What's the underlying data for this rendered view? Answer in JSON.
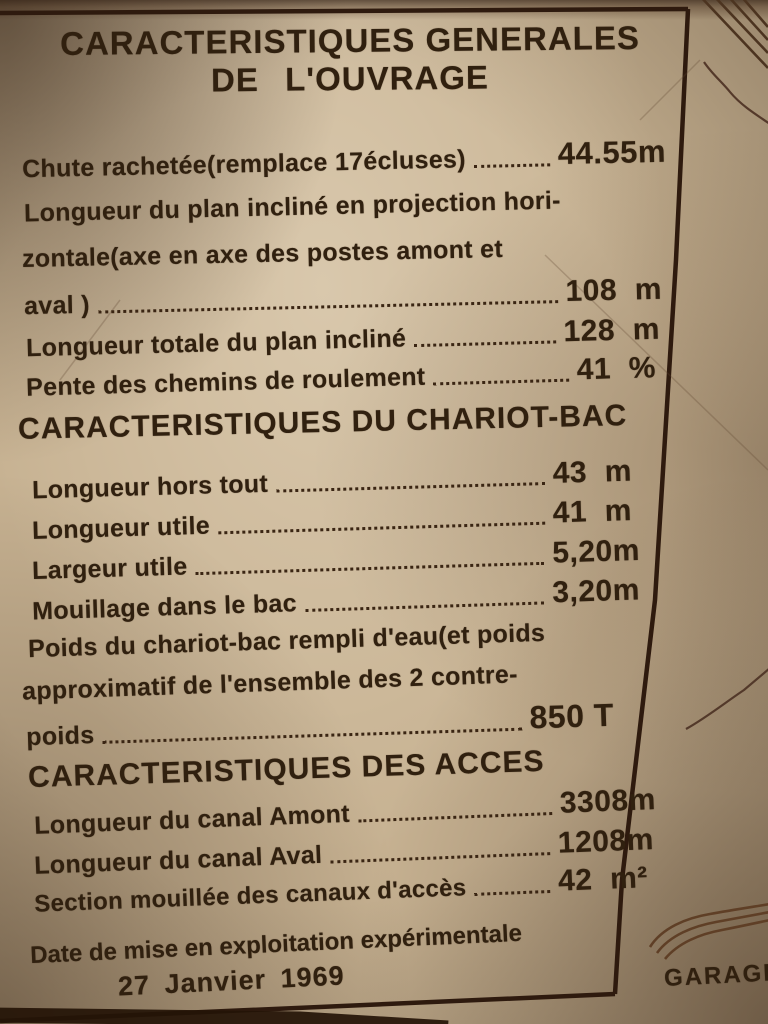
{
  "colors": {
    "paper": "#c7b292",
    "ink": "#30200f",
    "frame": "#2e1a0e"
  },
  "title": {
    "line1": "CARACTERISTIQUES GENERALES",
    "line2": "DE L'OUVRAGE"
  },
  "general": {
    "row_chute": {
      "label": "Chute rachetée(remplace 17écluses)",
      "value": "44.55m"
    },
    "wrap1": "Longueur du plan incliné en projection hori-",
    "wrap2": "zontale(axe en axe des postes amont et",
    "row_aval": {
      "label": "aval )",
      "value": "108  m"
    },
    "row_totale": {
      "label": "Longueur totale du plan incliné",
      "value": "128  m"
    },
    "row_pente": {
      "label": "Pente des chemins de roulement",
      "value": "41  %"
    }
  },
  "chariot": {
    "header": "CARACTERISTIQUES DU CHARIOT-BAC",
    "row_hors_tout": {
      "label": "Longueur hors tout",
      "value": "43  m"
    },
    "row_utile": {
      "label": "Longueur utile",
      "value": "41  m"
    },
    "row_largeur": {
      "label": "Largeur utile",
      "value": "5,20m"
    },
    "row_mouillage": {
      "label": "Mouillage dans le bac",
      "value": "3,20m"
    },
    "wrap1": "Poids du chariot-bac rempli d'eau(et poids",
    "wrap2": "approximatif de l'ensemble des 2 contre-",
    "row_poids": {
      "label": "poids",
      "value": "850 T"
    }
  },
  "acces": {
    "header": "CARACTERISTIQUES DES ACCES",
    "row_amont": {
      "label": "Longueur du canal Amont",
      "value": "3308m"
    },
    "row_aval": {
      "label": "Longueur du canal Aval",
      "value": "1208m"
    },
    "row_section": {
      "label": "Section mouillée des canaux d'accès",
      "value": "42  m²"
    }
  },
  "footer": {
    "line1": "Date de mise en exploitation expérimentale",
    "line2": "27 Janvier 1969"
  },
  "margin": {
    "garage_label": "GARAGE"
  }
}
